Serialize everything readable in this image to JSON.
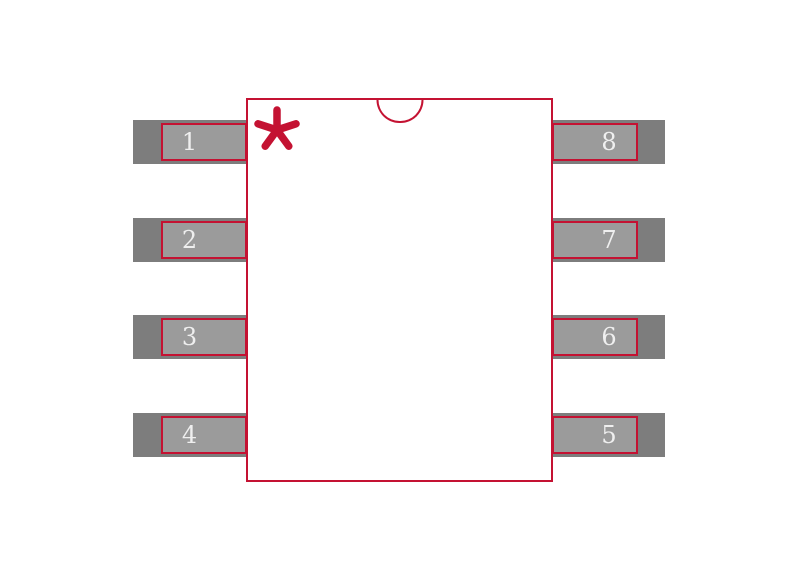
{
  "diagram": {
    "type": "ic-package-footprint",
    "pin_count": 8,
    "pin1_marker": "*",
    "pins": {
      "left": [
        {
          "number": "1"
        },
        {
          "number": "2"
        },
        {
          "number": "3"
        },
        {
          "number": "4"
        }
      ],
      "right": [
        {
          "number": "8"
        },
        {
          "number": "7"
        },
        {
          "number": "6"
        },
        {
          "number": "5"
        }
      ]
    }
  },
  "colors": {
    "outline-red": "#c41232",
    "pad-dark": "#7d7d7d",
    "pad-light": "#9b9b9b",
    "pin-text": "#efefef",
    "background": "#ffffff"
  }
}
